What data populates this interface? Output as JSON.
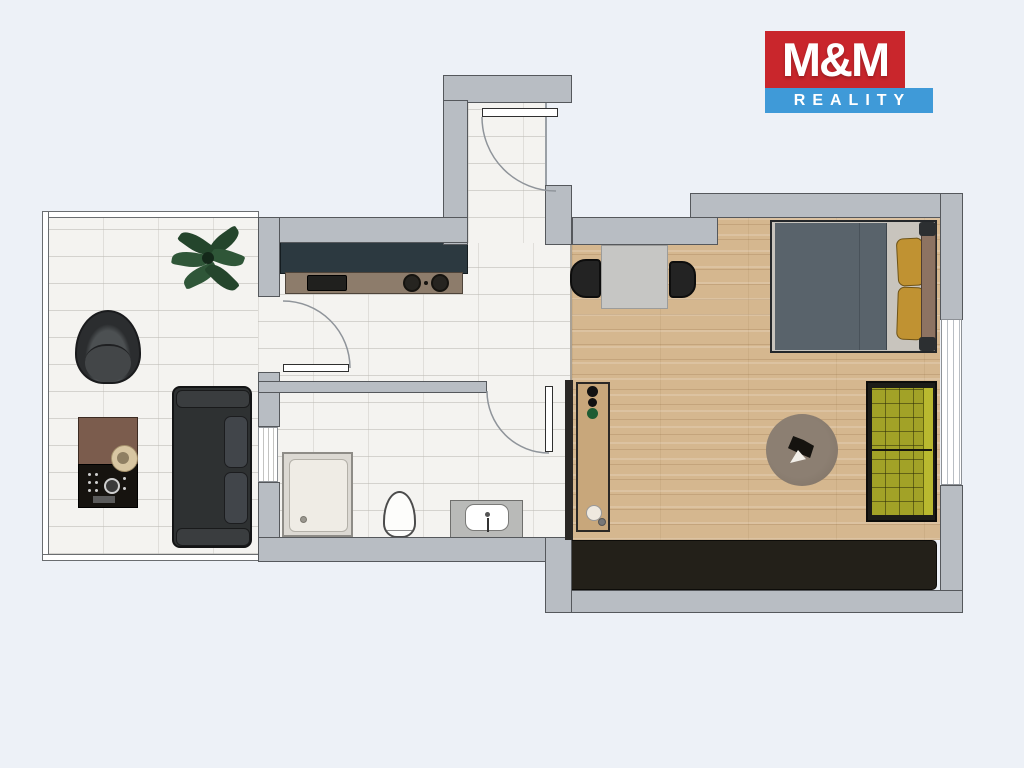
{
  "logo": {
    "title": "M&M",
    "subtitle": "REALITY",
    "colors": {
      "title_bg": "#c9262c",
      "subtitle_bg": "#3f9ad8",
      "text": "#ffffff"
    }
  },
  "floorplan": {
    "colors": {
      "background": "#edf1f7",
      "wall": "#b8bdc3",
      "wall_outline": "#55585c",
      "tile_floor": "#f4f3f0",
      "wood_floor": "#d5b78f",
      "kitchen_cabinet_dark": "#2c3940",
      "kitchen_counter_brown": "#8d7c6b",
      "sofa_dark": "#2e3132",
      "bed_duvet": "#59636b",
      "pillow_mustard": "#c09232",
      "bench_olive": "#a2a227",
      "wardrobe_dark": "#232019",
      "rug_brown": "#84766a",
      "plant_green": "#2f5638",
      "table_marble": "#c6c6c4",
      "console_wood": "#c8a77b"
    }
  }
}
